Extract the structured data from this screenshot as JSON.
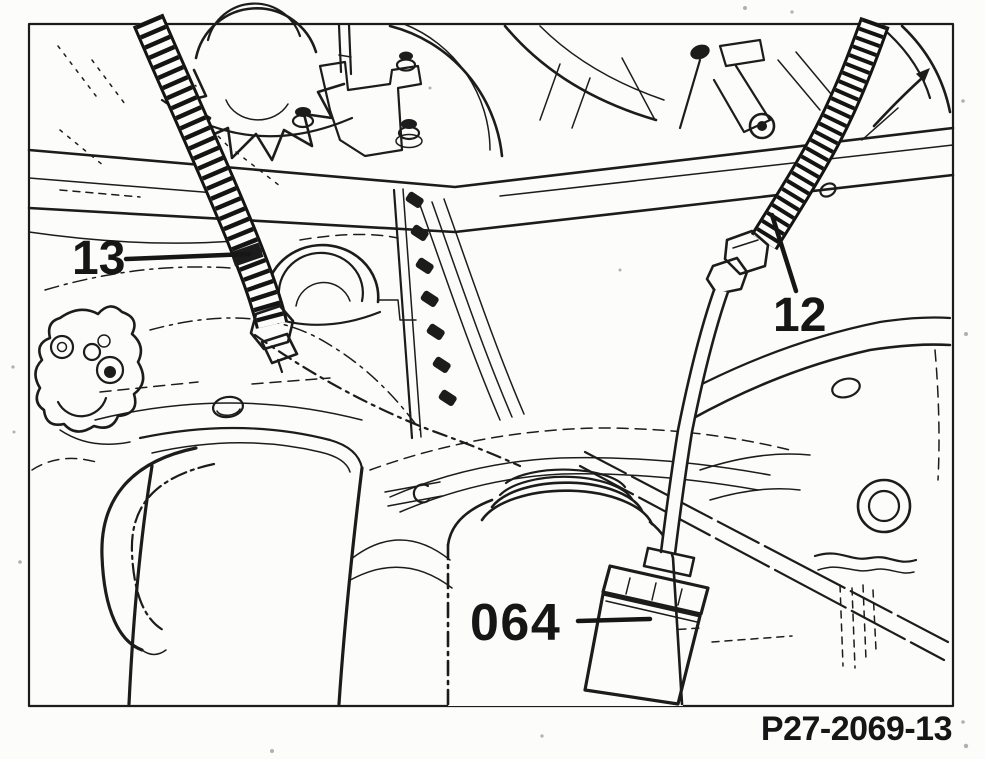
{
  "illustration": {
    "figure_ref": "P27-2069-13",
    "callouts": [
      {
        "label": "13"
      },
      {
        "label": "12"
      },
      {
        "label": "064"
      }
    ],
    "colors": {
      "ink": "#1c1c1c",
      "paper": "#fcfcfa"
    }
  }
}
